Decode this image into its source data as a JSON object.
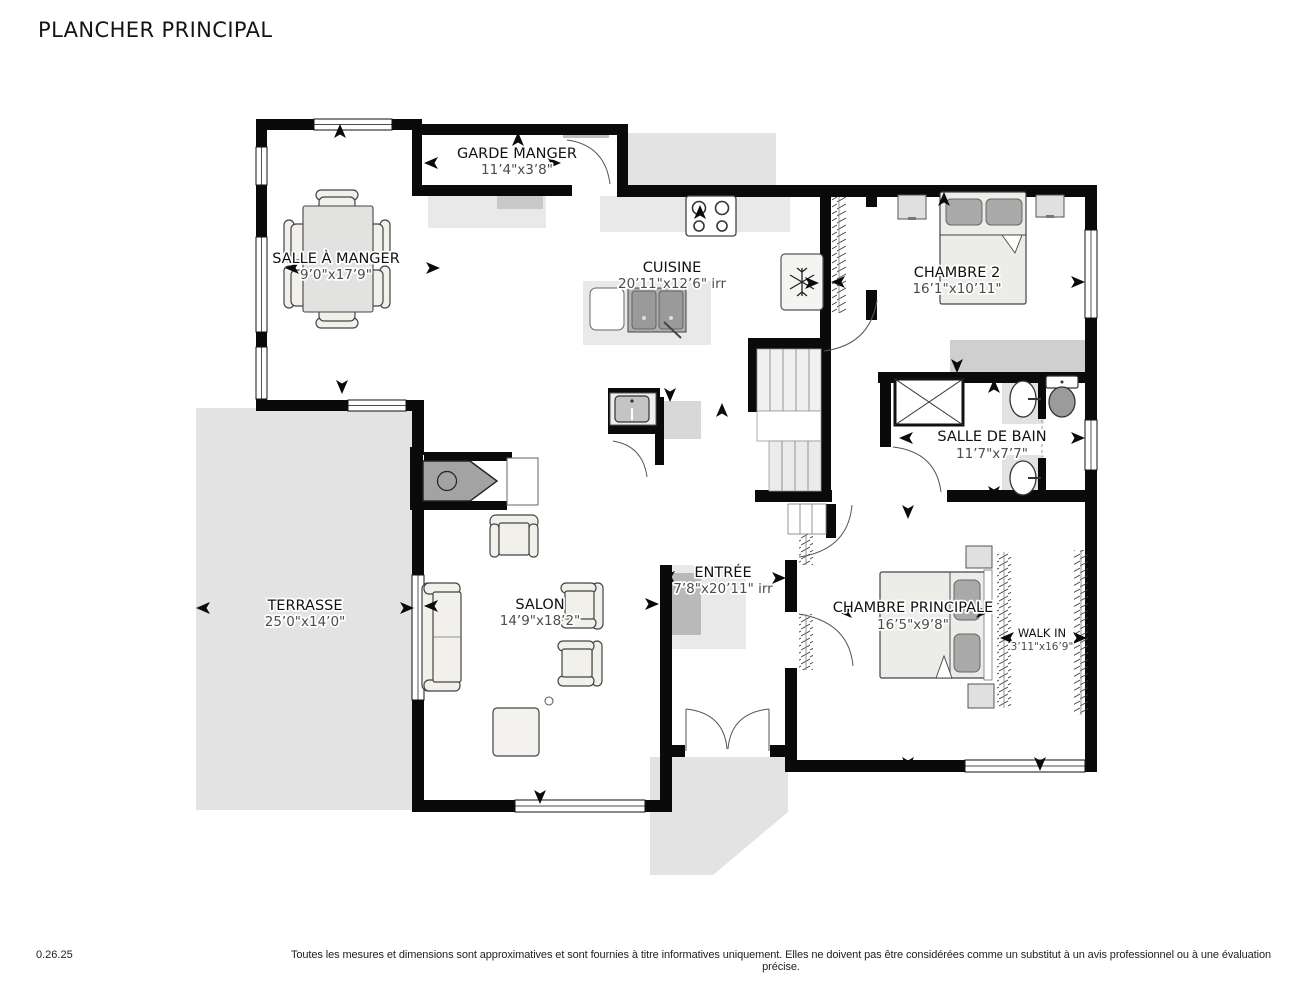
{
  "title": "PLANCHER PRINCIPAL",
  "footer": {
    "version": "0.26.25",
    "disclaimer": "Toutes les mesures et dimensions sont approximatives et sont fournies à titre informatives uniquement. Elles ne doivent pas être considérées comme un substitut à un avis professionnel ou à une évaluation précise."
  },
  "rooms": {
    "garde_manger": {
      "name": "GARDE MANGER",
      "dims": "11’4\"x3’8\""
    },
    "salle_a_manger": {
      "name": "SALLE À MANGER",
      "dims": "9’0\"x17’9\""
    },
    "cuisine": {
      "name": "CUISINE",
      "dims": "20’11\"x12’6\" irr"
    },
    "chambre2": {
      "name": "CHAMBRE 2",
      "dims": "16’1\"x10’11\""
    },
    "salle_de_bain": {
      "name": "SALLE DE BAIN",
      "dims": "11’7\"x7’7\""
    },
    "entree": {
      "name": "ENTRÉE",
      "dims": "7’8\"x20’11\" irr"
    },
    "salon": {
      "name": "SALON",
      "dims": "14’9\"x18’2\""
    },
    "terrasse": {
      "name": "TERRASSE",
      "dims": "25’0\"x14’0\""
    },
    "chambre_principale": {
      "name": "CHAMBRE PRINCIPALE",
      "dims": "16’5\"x9’8\""
    },
    "walk_in": {
      "name": "WALK IN",
      "dims": "3’11\"x16’9\""
    }
  },
  "colors": {
    "wall": "#0a0a0a",
    "terrace": "#e3e3e3",
    "counter": "#e9e9e9",
    "furniture": "#f1f0ea",
    "fixture_dark": "#a8a8a8",
    "dim_text": "#4d4d4d"
  }
}
